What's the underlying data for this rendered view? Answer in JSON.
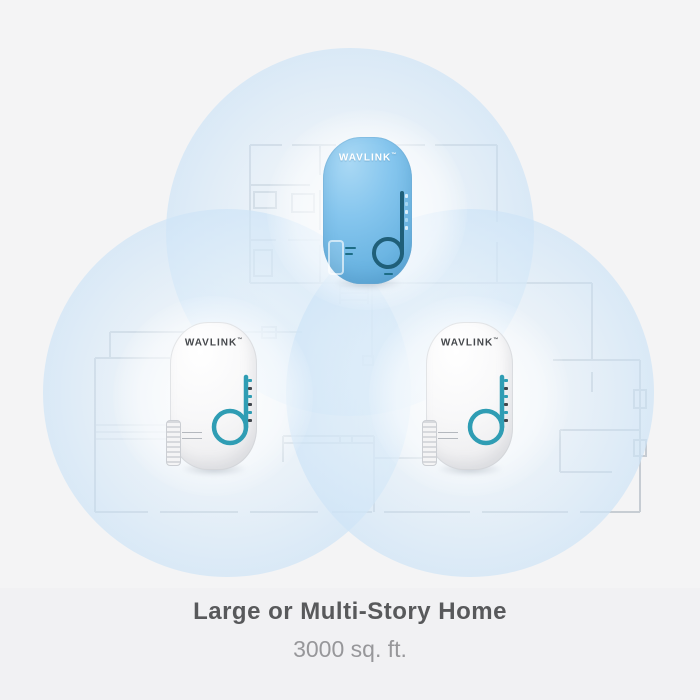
{
  "scene": {
    "caption": {
      "title": "Large or Multi-Story Home",
      "subtitle": "3000 sq. ft."
    },
    "brand": "WAVLINK",
    "trademark": "™",
    "devices": [
      {
        "id": "top",
        "variant": "blue",
        "logo": "WAVLINK"
      },
      {
        "id": "bottom-left",
        "variant": "white",
        "logo": "WAVLINK"
      },
      {
        "id": "bottom-right",
        "variant": "white",
        "logo": "WAVLINK"
      }
    ],
    "coverage_circles": 3,
    "colors": {
      "background": "#f4f4f5",
      "coverage_blue": "#c5ddf4",
      "device_blue": "#7fc2ea",
      "accent_teal": "#2f9db4",
      "blue_device_accent": "#1f5f79",
      "title_text": "#58595b",
      "subtitle_text": "#97979a",
      "floorplan_line": "#9aa5b2"
    }
  }
}
